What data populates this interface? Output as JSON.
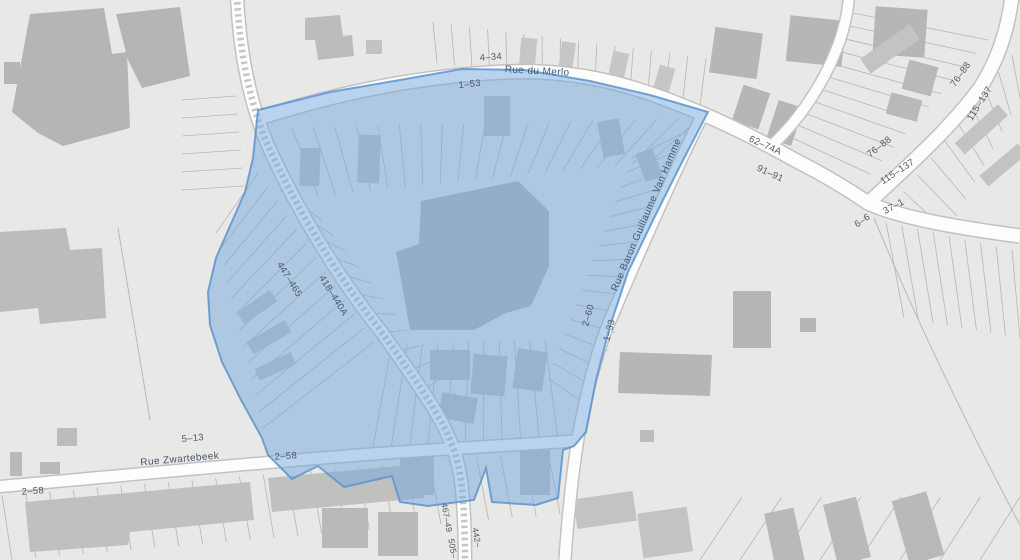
{
  "map": {
    "streets": {
      "rue_du_merlo": "Rue du Merlo",
      "rue_baron": "Rue Baron Guillaume Van Hamme",
      "rue_zwartebeek": "Rue Zwartebeek"
    },
    "ranges": {
      "r4_34": "4–34",
      "r1_53": "1–53",
      "r62_74A": "62–74A",
      "r91_91": "91–91",
      "r76_88_outer": "76–88",
      "r115_137_outer": "115–137",
      "r76_88_inner": "76–88",
      "r115_137_inner": "115–137",
      "r37_1": "37–1",
      "r6_6": "6–6",
      "r2_60": "2–60",
      "r1_33": "1–33",
      "r447_465": "447–465",
      "r418_440A": "418–440A",
      "r5_13": "5–13",
      "r2_58_west": "2–58",
      "r2_58_east": "2–58",
      "r467_49": "467–49",
      "r505": "505–",
      "r442": "442–"
    },
    "overlay_fill": "#75a8de",
    "overlay_border": "#5d94cf"
  }
}
